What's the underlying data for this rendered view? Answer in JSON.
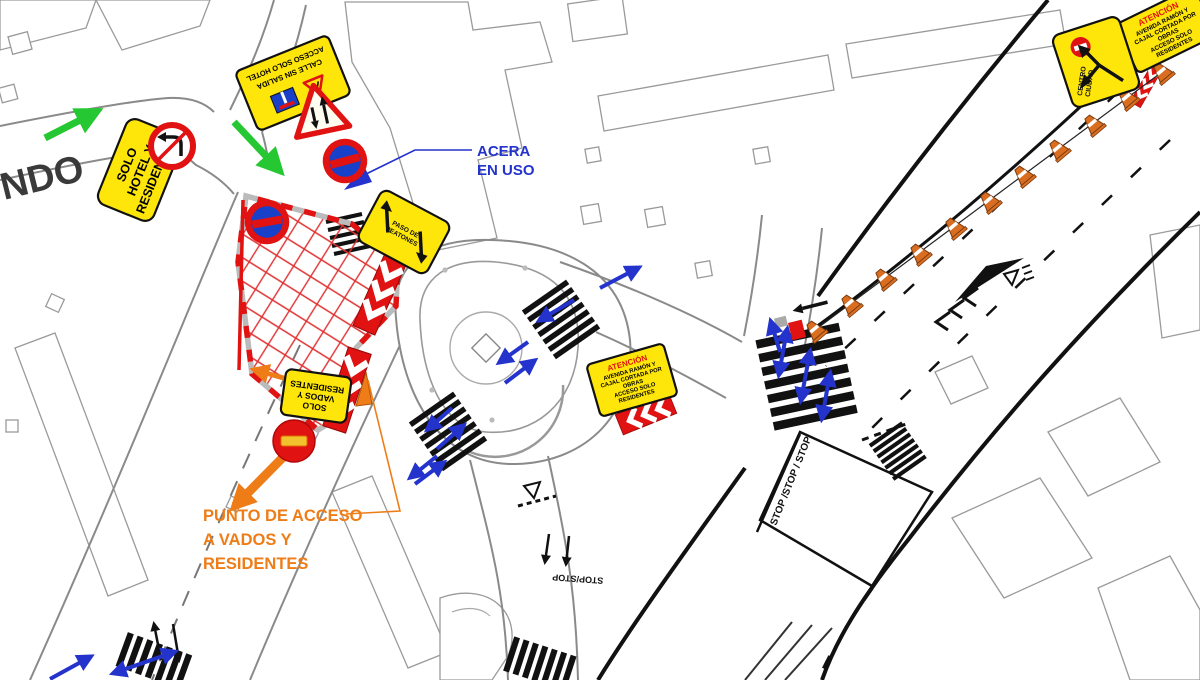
{
  "drawing": {
    "street_name_fragment": "NDO",
    "notes": {
      "acera_l1": "ACERA",
      "acera_l2": "EN USO",
      "punto_l1": "PUNTO DE ACCESO",
      "punto_l2": "A VADOS Y",
      "punto_l3": "RESIDENTES"
    },
    "signs": {
      "solo_hotel": {
        "l1": "SOLO",
        "l2": "HOTEL Y",
        "l3": "RESIDENTES"
      },
      "calle_sin_salida": {
        "l1": "CALLE SIN SALIDA",
        "l2": "ACCESO SOLO HOTEL"
      },
      "paso_peatones": {
        "l1": "PASO DE",
        "l2": "PEATONES"
      },
      "solo_vados": {
        "l1": "SOLO",
        "l2": "VADOS Y",
        "l3": "RESIDENTES"
      },
      "atencion": {
        "header": "ATENCIÓN",
        "l1": "AVENIDA  RAMÓN Y",
        "l2": "CAJAL CORTADA POR",
        "l3": "OBRAS",
        "l4": "ACCESO SOLO",
        "l5": "RESIDENTES"
      },
      "centro_ciudad": {
        "l1": "CENTRO",
        "l2": "CIUDAD"
      }
    },
    "road_markings": {
      "stop_triple": "STOP /STOP / STOP",
      "stop_double": "STOP/STOP"
    },
    "colors": {
      "sign_yellow": "#FFE60A",
      "prohibition_red": "#E01212",
      "no_stopping_blue": "#1840C8",
      "arrow_blue": "#2333CC",
      "arrow_green": "#25C832",
      "accent_orange": "#EE7D18",
      "work_zone_red": "#E03030",
      "building_grey": "#9A9A9A"
    }
  }
}
